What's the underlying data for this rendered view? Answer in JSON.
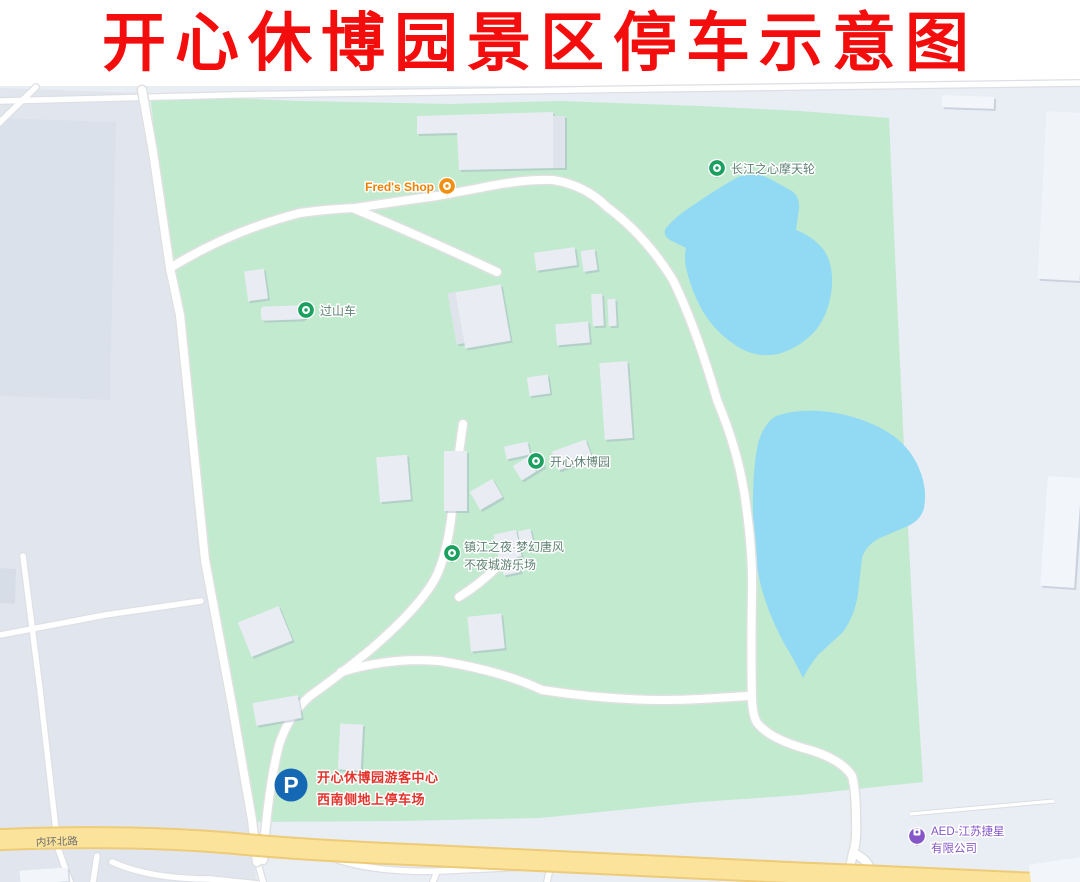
{
  "title": "开心休博园景区停车示意图",
  "colors": {
    "title_red": "#F40D0D",
    "park_green": "#C2EACF",
    "water_blue": "#92DAF3",
    "outside_gray": "#E9EDF4",
    "major_road_yellow": "#FBE39B",
    "poi_pin_green": "#1BA05F",
    "poi_label_green": "#5E8173",
    "shop_orange": "#EE8200",
    "aed_purple": "#8456C8",
    "parking_blue": "#1468B4",
    "parking_label_red": "#E2342C"
  },
  "map": {
    "street_label": "内环北路",
    "pois": [
      {
        "name": "ferris-wheel",
        "label": "长江之心摩天轮"
      },
      {
        "name": "roller-coaster",
        "label": "过山车"
      },
      {
        "name": "freds-shop",
        "label": "Fred's Shop"
      },
      {
        "name": "park-center",
        "label": "开心休博园"
      },
      {
        "name": "night-park",
        "label_line1": "镇江之夜·梦幻唐风",
        "label_line2": "不夜城游乐场"
      },
      {
        "name": "aed-company",
        "label_line1": "AED-江苏捷星",
        "label_line2": "有限公司"
      }
    ],
    "parking": {
      "icon_letter": "P",
      "label_line1": "开心休博园游客中心",
      "label_line2": "西南侧地上停车场"
    }
  }
}
